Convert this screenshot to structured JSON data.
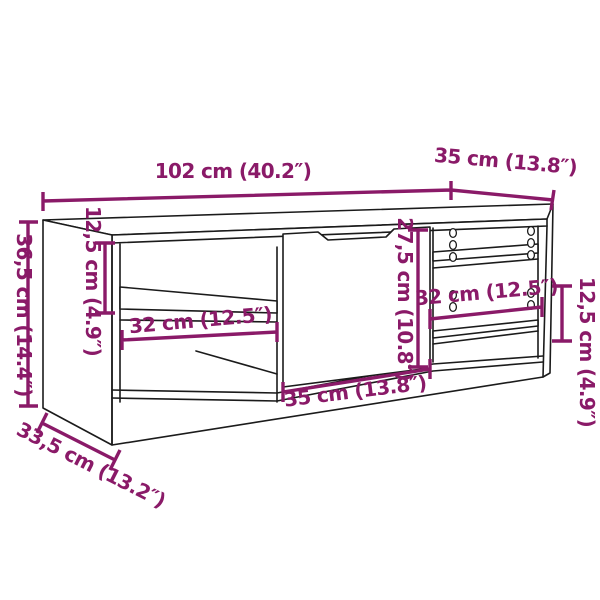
{
  "diagram": {
    "kind": "furniture-dimension-diagram",
    "subject": "TV cabinet with center door, side shelf compartments and shelf-pin holes"
  },
  "colors": {
    "dimension_annotation": "#8A1A68",
    "line_art": "#1b1b1b",
    "background": "#ffffff"
  },
  "dimensions": {
    "top_width": "102 cm (40.2″)",
    "top_depth": "35 cm (13.8″)",
    "height": "36,5 cm (14.4″)",
    "left_shelf_gap": "12,5 cm (4.9″)",
    "left_shelf_width": "32 cm (12.5″)",
    "door_height": "27,5 cm (10.8″)",
    "door_width": "35 cm (13.8″)",
    "right_shelf_width": "32 cm (12.5″)",
    "right_shelf_gap": "12,5 cm (4.9″)",
    "base_depth": "33,5 cm (13.2″)"
  }
}
